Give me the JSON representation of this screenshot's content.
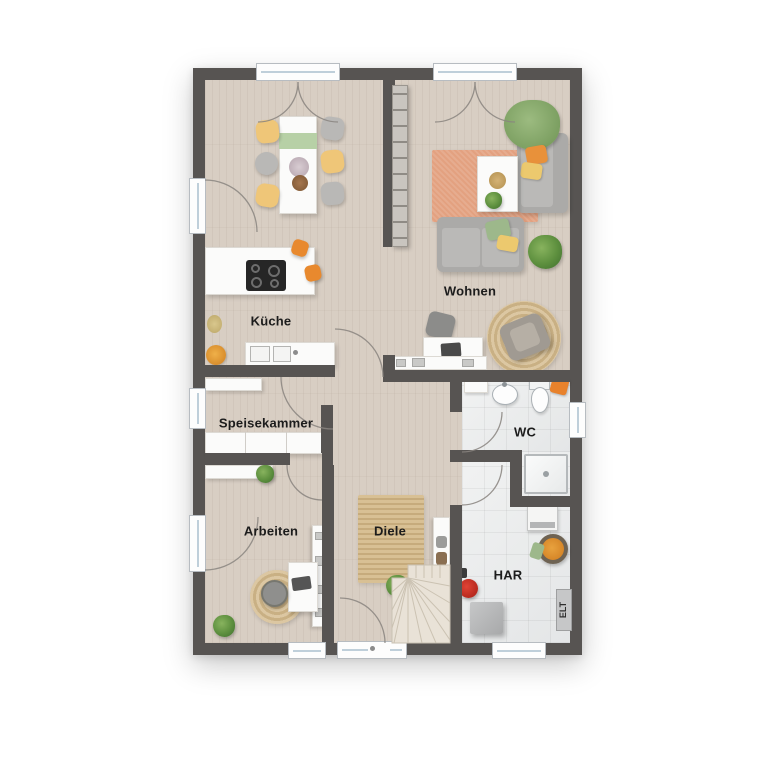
{
  "floorplan": {
    "type": "residential-ground-floor-plan",
    "rooms": [
      {
        "id": "kueche",
        "label": "Küche"
      },
      {
        "id": "wohnen",
        "label": "Wohnen"
      },
      {
        "id": "speisekammer",
        "label": "Speisekammer"
      },
      {
        "id": "arbeiten",
        "label": "Arbeiten"
      },
      {
        "id": "diele",
        "label": "Diele"
      },
      {
        "id": "wc",
        "label": "WC"
      },
      {
        "id": "har",
        "label": "HAR"
      }
    ],
    "panel_labels": {
      "elt": "ELT"
    },
    "colors": {
      "wall": "#575452",
      "wood_floor": "#d8cec3",
      "tile_floor": "#eceeee",
      "rug_salmon": "#e3a180",
      "rug_jute": "#d3b98f",
      "sofa_gray": "#abaaa8",
      "chair_yellow": "#efc678",
      "accent_orange": "#e8872f",
      "accent_green": "#9cba8a",
      "counter_white": "#fbfbfa"
    }
  }
}
